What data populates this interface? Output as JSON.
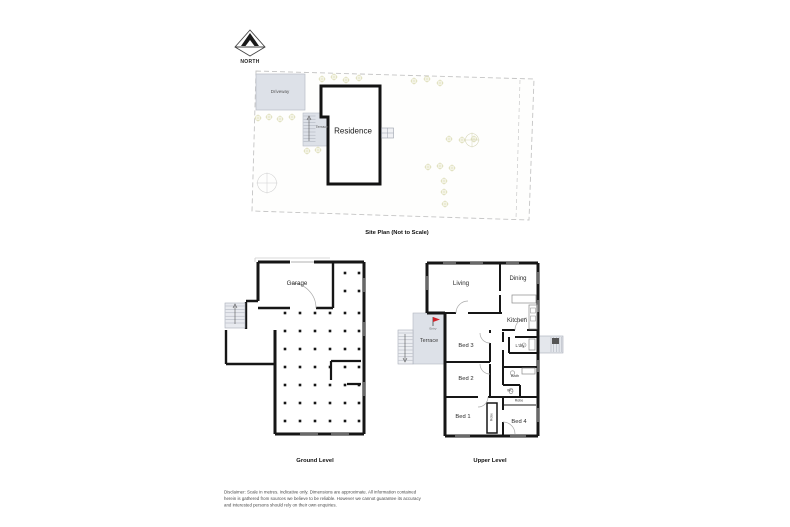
{
  "compass": {
    "label": "NORTH"
  },
  "site_plan": {
    "caption": "Site Plan (Not to Scale)",
    "driveway_label": "Driveway",
    "terrace_label": "Terrace",
    "residence_label": "Residence"
  },
  "ground_level": {
    "caption": "Ground Level",
    "garage_label": "Garage"
  },
  "upper_level": {
    "caption": "Upper Level",
    "living_label": "Living",
    "dining_label": "Dining",
    "kitchen_label": "Kitchen",
    "terrace_label": "Terrace",
    "entry_label": "Entry",
    "bed1_label": "Bed 1",
    "bed2_label": "Bed 2",
    "bed3_label": "Bed 3",
    "bed4_label": "Bed 4",
    "laundry_label": "L'dry",
    "bath_label": "Bath",
    "wc_label": "WC",
    "robe_label": "Robe",
    "robe2_label": "Robe"
  },
  "disclaimer": {
    "line1": "Disclaimer: Scale in metres. Indicative only. Dimensions are approximate. All information contained",
    "line2": "herein is gathered from sources we believe to be reliable. However we cannot guarantee its accuracy",
    "line3": "and interested persons should rely on their own enquiries."
  },
  "colors": {
    "wall": "#161616",
    "paved_area": "#dde1e8",
    "stairs": "#e8eaef",
    "tree": "#d4d4a4",
    "boundary_dash": "#c4c4c4",
    "entry_flag": "#cf2128"
  }
}
